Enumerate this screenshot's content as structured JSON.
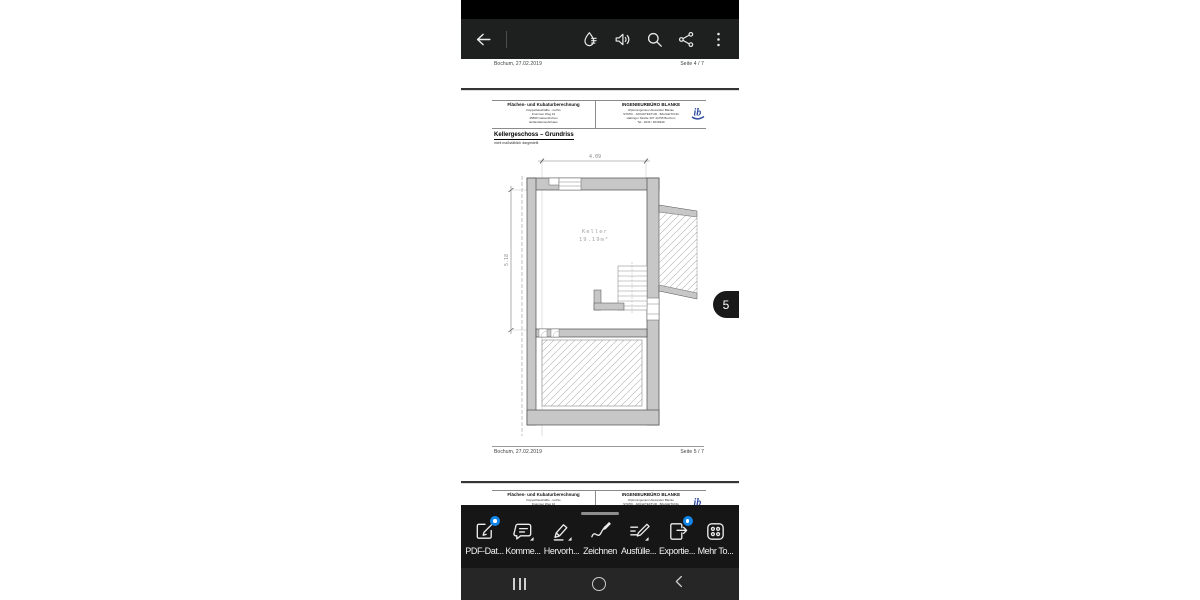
{
  "app_bar": {
    "icons": [
      "back",
      "liquid-mode",
      "read-aloud",
      "search",
      "share",
      "overflow-menu"
    ]
  },
  "pdf": {
    "doc_header": {
      "left": {
        "title": "Flächen- und Kubaturberechnung",
        "line1": "Doppelhaushälfte - rechts",
        "line2": "Krummer Weg 16",
        "line3": "45896 Gelsenkirchen",
        "line4": "Einfamilienwohnhaus"
      },
      "right": {
        "title": "INGENIEURBÜRO BLANKE",
        "line1": "Diplomingenieur Alexander Blanke",
        "line2": "STATIK · ARCHITEKTUR · BAULEITUNG",
        "line3": "Hattinger Straße 407 44795 Bochum",
        "line4": "Tel.: 0234 / 9010949",
        "logo_text": "ib"
      }
    },
    "page4": {
      "footer_left": "Bochum, 27.02.2019",
      "footer_right": "Seite 4 / 7"
    },
    "page5": {
      "title": "Kellergeschoss – Grundriss",
      "subtitle": "nicht maßstäblich dargestellt",
      "plan": {
        "room_label": "Keller",
        "room_area": "19.19m²",
        "dim_width": "4.09",
        "dim_height": "5.18"
      },
      "footer_left": "Bochum, 27.02.2019",
      "footer_right": "Seite 5 / 7"
    },
    "page_badge": "5"
  },
  "toolbar": {
    "items": [
      {
        "label": "PDF-Dat...",
        "icon": "edit-pdf-icon",
        "badge": true
      },
      {
        "label": "Komme...",
        "icon": "comment-icon",
        "badge": false
      },
      {
        "label": "Hervorh...",
        "icon": "highlight-icon",
        "badge": false
      },
      {
        "label": "Zeichnen",
        "icon": "draw-icon",
        "badge": false
      },
      {
        "label": "Ausfülle...",
        "icon": "fill-sign-icon",
        "badge": false
      },
      {
        "label": "Exportie...",
        "icon": "export-icon",
        "badge": true
      },
      {
        "label": "Mehr To...",
        "icon": "more-tools-icon",
        "badge": false
      }
    ]
  },
  "nav_bar": {
    "icons": [
      "recents",
      "home",
      "back"
    ]
  },
  "colors": {
    "badge_blue": "#1285e8",
    "logo_blue": "#2d4a9e",
    "wall_gray": "#c7c7c7",
    "appbar_bg": "#1e1f1f",
    "toolbar_bg": "#161616",
    "nav_bg": "#262626"
  }
}
